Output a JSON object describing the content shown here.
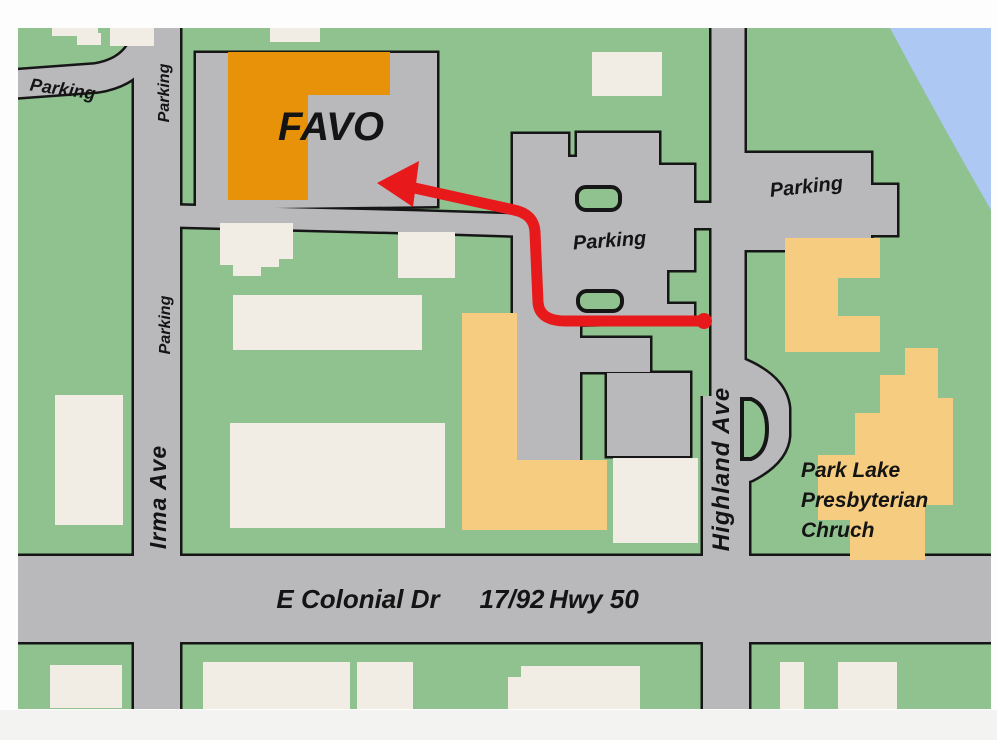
{
  "labels": {
    "favo": "FAVO",
    "parking_topleft": "Parking",
    "parking_irma_upper": "Parking",
    "parking_irma_lower": "Parking",
    "irma_ave": "Irma Ave",
    "parking_central": "Parking",
    "parking_east": "Parking",
    "highland_ave": "Highland Ave",
    "colonial": "E Colonial Dr",
    "highway_number": "17/92",
    "highway_name": "Hwy 50",
    "church_line1": "Park Lake",
    "church_line2": "Presbyterian",
    "church_line3": "Chruch"
  },
  "palette": {
    "green": "#8FC28F",
    "road": "#B9B9BC",
    "cream": "#F1ECE4",
    "tan": "#F6CC80",
    "orange": "#E8920A",
    "water": "#ADC8F3",
    "outline": "#161616",
    "route": "#E8191B",
    "page-bottom": "#F3F3F1"
  }
}
